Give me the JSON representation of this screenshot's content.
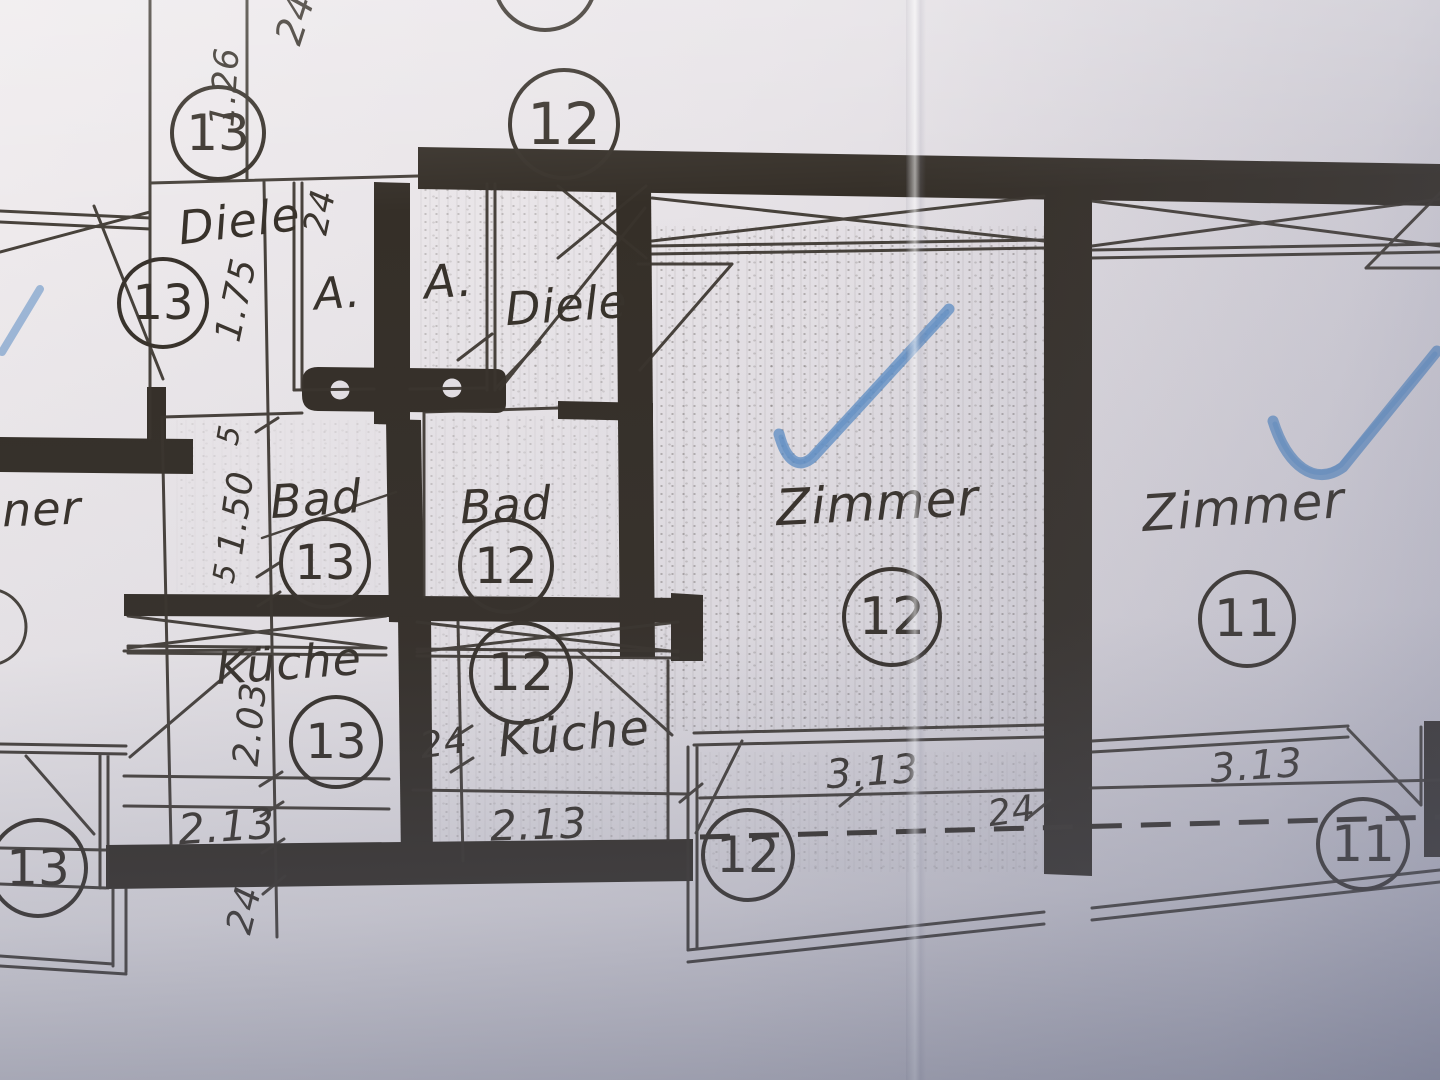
{
  "plan": {
    "rooms": {
      "diele_left": "Diele",
      "a_left": "A.",
      "a_right": "A.",
      "diele_right": "Diele",
      "bad_left": "Bad",
      "bad_right": "Bad",
      "kueche_left": "Küche",
      "kueche_right": "Küche",
      "zimmer_mid": "Zimmer",
      "zimmer_right": "Zimmer",
      "zimmer_partial": "ner"
    },
    "circle_numbers": {
      "top_left": "13",
      "top_center": "12",
      "top_center_partial": "17",
      "diele_left": "13",
      "bad_left": "13",
      "kueche_left": "13",
      "bad_right": "12",
      "kueche_right": "12",
      "zimmer_mid": "12",
      "zimmer_right": "11",
      "balcony_left": "13",
      "balcony_mid": "12",
      "balcony_right": "11"
    },
    "dimensions": {
      "top_24": "24",
      "left_1_26": "1.26",
      "left_1_75": "1.75",
      "closet_24": "24",
      "bad_5_top": "5",
      "bad_1_50": "1.50",
      "bad_5_bottom": "5",
      "kueche_2_03": "2.03",
      "mid_24": "24",
      "kueche_left_2_13": "2.13",
      "kueche_right_2_13": "2.13",
      "bottom_left_24": "24",
      "balcony_left_3_13": "3.13",
      "balcony_24": "24",
      "balcony_right_3_13": "3.13"
    },
    "marks": {
      "check_left": "blue-checkmark",
      "check_right": "blue-checkmark"
    },
    "colors": {
      "ink": "#38322b",
      "paper": "#e7e3e7",
      "check_blue": "#5b8cc4"
    }
  }
}
